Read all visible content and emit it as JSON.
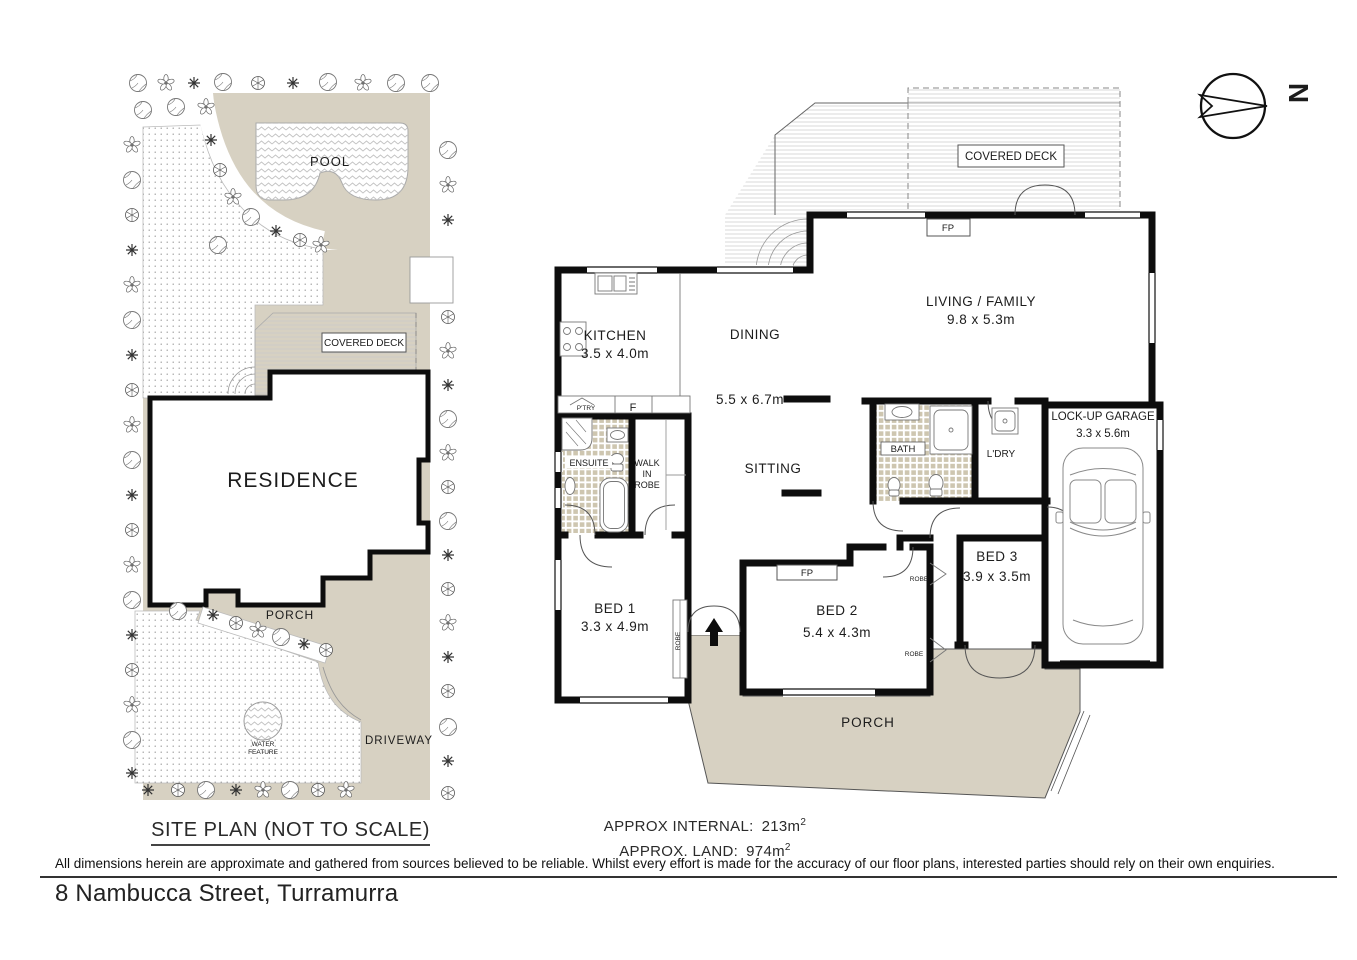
{
  "colors": {
    "paper": "#ffffff",
    "ground_beige": "#d7d1c2",
    "wall_black": "#0d0d0d",
    "tile_beige": "#cec6b0",
    "hatch_grey": "#cccccc",
    "text_dark": "#1c1c1c"
  },
  "site_plan": {
    "title": "SITE PLAN (NOT TO SCALE)",
    "pool": "POOL",
    "residence": "RESIDENCE",
    "covered_deck": "COVERED DECK",
    "porch": "PORCH",
    "driveway": "DRIVEWAY",
    "water_line1": "WATER",
    "water_line2": "FEATURE"
  },
  "floor_plan": {
    "compass_n": "N",
    "covered_deck": "COVERED DECK",
    "fp": "FP",
    "living_name": "LIVING / FAMILY",
    "living_dim": "9.8 x 5.3m",
    "dining": "DINING",
    "open_dim": "5.5 x 6.7m",
    "sitting": "SITTING",
    "kitchen_name": "KITCHEN",
    "kitchen_dim": "3.5 x 4.0m",
    "pantry": "P'TRY",
    "fridge": "F",
    "ensuite": "ENSUITE",
    "wir_line1": "WALK",
    "wir_line2": "IN",
    "wir_line3": "ROBE",
    "bath": "BATH",
    "laundry": "L'DRY",
    "garage_name": "LOCK-UP GARAGE",
    "garage_dim": "3.3 x 5.6m",
    "bed1_name": "BED 1",
    "bed1_dim": "3.3 x 4.9m",
    "bed2_name": "BED 2",
    "bed2_dim": "5.4 x 4.3m",
    "bed3_name": "BED 3",
    "bed3_dim": "3.9 x 3.5m",
    "porch": "PORCH",
    "robe": "ROBE"
  },
  "summary": {
    "internal_label": "APPROX INTERNAL:",
    "internal_value": "213m",
    "internal_sup": "2",
    "land_label": "APPROX. LAND:",
    "land_value": "974m",
    "land_sup": "2"
  },
  "footer": {
    "disclaimer": "All dimensions herein are approximate and gathered from sources believed to be reliable. Whilst every effort is made for the accuracy of our floor plans, interested parties should rely on their own enquiries.",
    "address": "8 Nambucca Street, Turramurra"
  }
}
